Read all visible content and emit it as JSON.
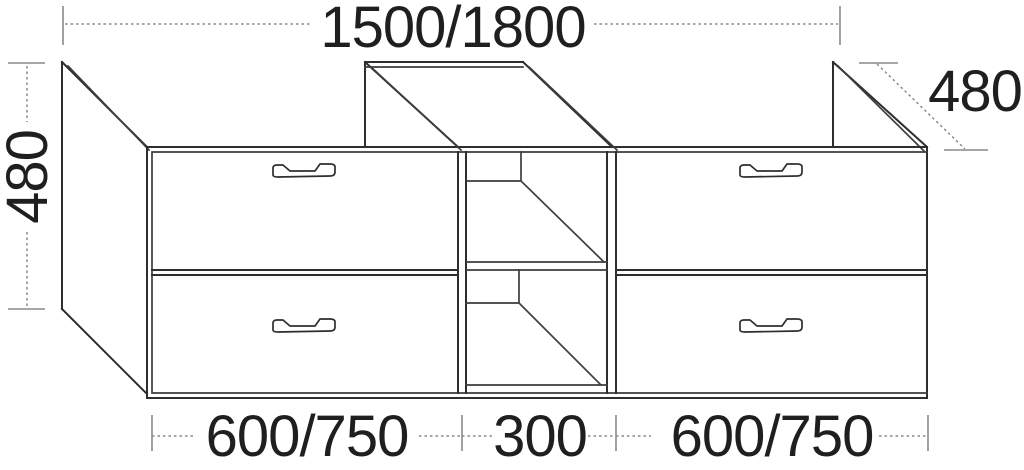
{
  "dimensions": {
    "total_width": "1500/1800",
    "height": "480",
    "depth": "480",
    "bottom_left_width": "600/750",
    "bottom_middle_width": "300",
    "bottom_right_width": "600/750"
  }
}
